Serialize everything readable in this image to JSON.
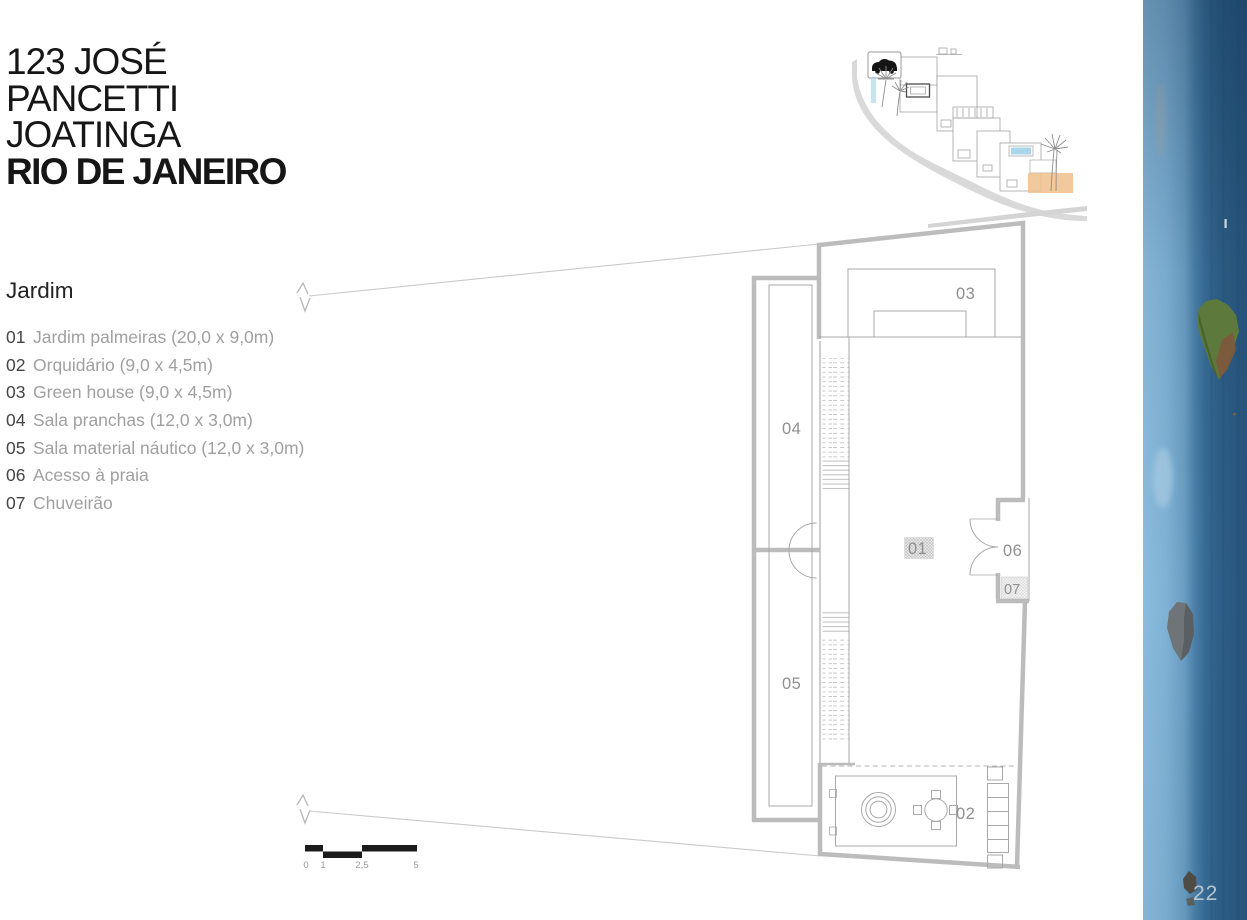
{
  "title": {
    "lines": [
      "123 JOSÉ",
      "PANCETTI",
      "JOATINGA",
      "RIO DE JANEIRO"
    ]
  },
  "legend": {
    "heading": "Jardim",
    "items": [
      {
        "num": "01",
        "label": "Jardim palmeiras (20,0 x 9,0m)"
      },
      {
        "num": "02",
        "label": "Orquidário (9,0 x 4,5m)"
      },
      {
        "num": "03",
        "label": "Green house (9,0 x 4,5m)"
      },
      {
        "num": "04",
        "label": "Sala pranchas (12,0 x 3,0m)"
      },
      {
        "num": "05",
        "label": "Sala material náutico (12,0 x 3,0m)"
      },
      {
        "num": "06",
        "label": "Acesso à praia"
      },
      {
        "num": "07",
        "label": "Chuveirão"
      }
    ]
  },
  "plan": {
    "labels": {
      "r01": "01",
      "r02": "02",
      "r03": "03",
      "r04": "04",
      "r05": "05",
      "r06": "06",
      "r07": "07"
    }
  },
  "scale_bar": {
    "ticks": [
      "0",
      "1",
      "2,5",
      "5"
    ]
  },
  "page_number": "22",
  "colors": {
    "wall_gray": "#bcbcbc",
    "line_gray": "#a8a8a8",
    "slope_gray": "#d9d9d9",
    "highlight_orange": "#eec08c",
    "pool_blue": "#a9d6ea",
    "sky_blue": "#7fb2d5",
    "sea_blue": "#2a5880",
    "scale_black": "#1c1c1c"
  }
}
